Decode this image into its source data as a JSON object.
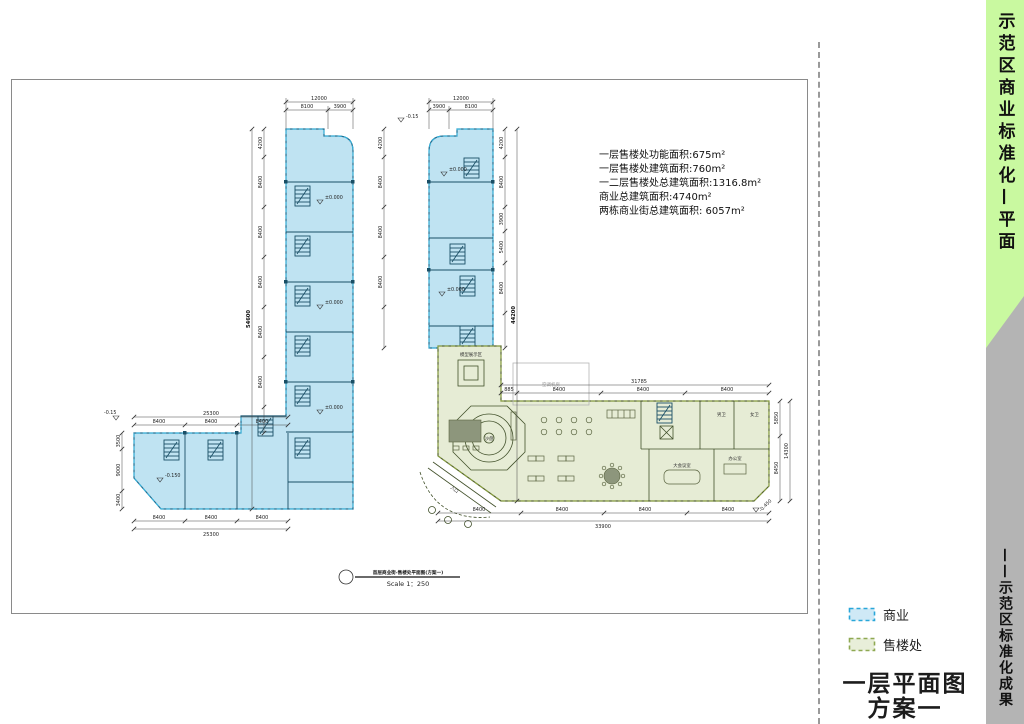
{
  "banner": {
    "top_text": "示范区商业标准化—平面",
    "bottom_text": "——示范区标准化成果",
    "green_color": "#c9f9a0",
    "gray_color": "#b4b4b4"
  },
  "legend": {
    "items": [
      {
        "label": "商业",
        "fill": "#cfe9f6",
        "border": "#2aa7d9"
      },
      {
        "label": "售楼处",
        "fill": "#e8eed9",
        "border": "#8fa953"
      }
    ]
  },
  "sheet_title": {
    "line1": "一层平面图",
    "line2": "方案一"
  },
  "annotations": {
    "lines": [
      "一层售楼处功能面积:675m²",
      "一层售楼处建筑面积:760m²",
      "一二层售楼处总建筑面积:1316.8m²",
      "商业总建筑面积:4740m²",
      "两栋商业街总建筑面积: 6057m²"
    ]
  },
  "scale": {
    "caption": "首层商业街-售楼处平面图(方案一)",
    "text": "Scale 1：250"
  },
  "plan": {
    "labels": {
      "entrance": "入口",
      "model_area": "模型展示区",
      "ac": "空调机房",
      "sand_table": "沙盘",
      "meeting": "大会议室",
      "office": "办公室",
      "toilet_m": "男卫",
      "toilet_f": "女卫"
    },
    "levels": {
      "zero": "±0.000",
      "m015": "-0.15",
      "m0150": "-0.150",
      "m0450": "-0.450"
    },
    "dims": {
      "d12000": "12000",
      "d8100": "8100",
      "d3900": "3900",
      "d4200": "4200",
      "d8400": "8400",
      "d54600": "54600",
      "d25300": "25300",
      "d3500": "3500",
      "d9000": "9000",
      "d3400": "3400",
      "d44200": "44200",
      "d5400": "5400",
      "d31785": "31785",
      "d885": "885",
      "d33900": "33900",
      "d14300": "14300",
      "d5850": "5850",
      "d8450": "8450"
    },
    "fills": {
      "commercial": "#bfe3f2",
      "sales_office": "#e6ecd5"
    }
  }
}
